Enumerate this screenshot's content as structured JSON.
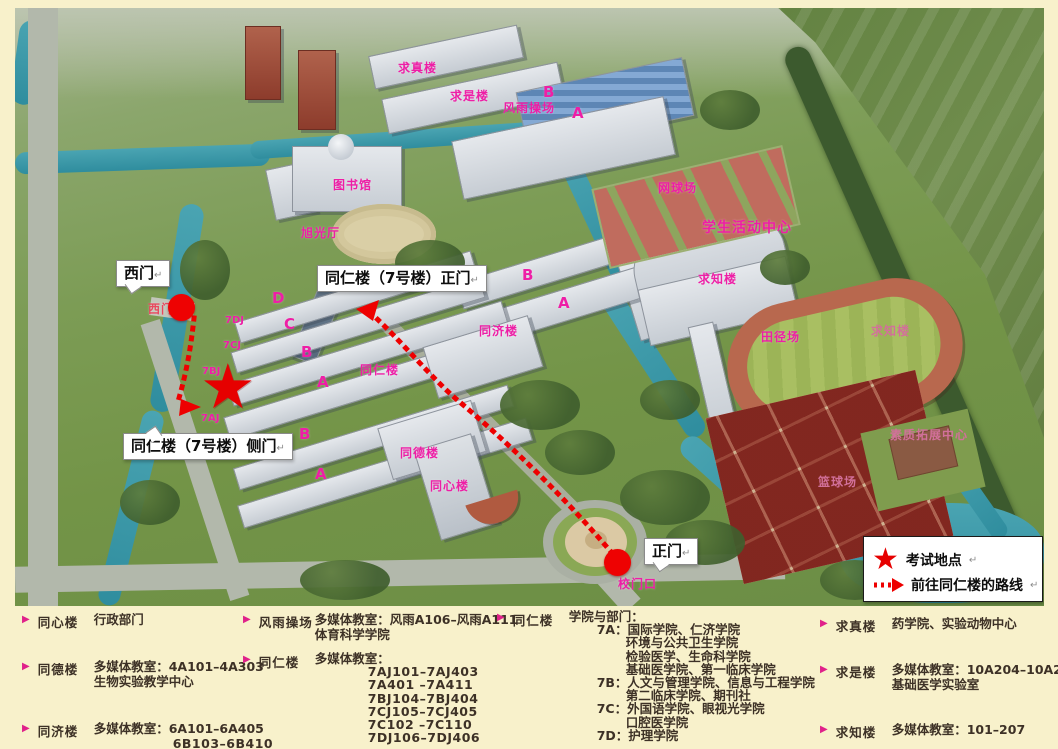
{
  "colors": {
    "accent_red": "#ee0000",
    "label_pink": "#ee1ea6",
    "panel_bg": "#f8f1cb"
  },
  "map": {
    "labels": {
      "qiuzhen": "求真楼",
      "qiushi": "求是楼",
      "fengyu": "风雨操场",
      "fengyu_b": "B",
      "fengyu_a": "A",
      "library": "图书馆",
      "xuguang": "旭光厅",
      "tennis": "网球场",
      "activity": "学生活动中心",
      "qiuzhi": "求知楼",
      "qiuzhi_east": "求知楼",
      "track": "田径场",
      "suzhi": "素质拓展中心",
      "basketball": "篮球场",
      "ximenkou": "西门口",
      "blk_d": "D",
      "blk_c": "C",
      "blk_b": "B",
      "blk_a": "A",
      "dj": "7DJ",
      "cj": "7CJ",
      "bj": "7BJ",
      "aj": "7AJ",
      "tongren": "同仁楼",
      "tongji_b": "B",
      "tongji_a": "A",
      "tongji": "同济楼",
      "blk_b2": "B",
      "blk_a2": "A",
      "tongde": "同德楼",
      "tongxin": "同心楼",
      "xiaomenkou": "校门口"
    },
    "callouts": {
      "west_gate": "西门",
      "front_door": "同仁楼（7号楼）正门",
      "side_door": "同仁楼（7号楼）侧门",
      "main_gate": "正门",
      "mark": "↵"
    },
    "legend": {
      "exam": "考试地点",
      "route": "前往同仁楼的路线",
      "mark": "↵"
    }
  },
  "panel": {
    "bullet": "▶",
    "groups": [
      {
        "name": "同心楼",
        "lines": [
          "行政部门"
        ]
      },
      {
        "name": "同德楼",
        "lines": [
          "多媒体教室：4A101–4A303",
          "生物实验教学中心"
        ]
      },
      {
        "name": "同济楼",
        "lines": [
          "多媒体教室：6A101–6A405",
          "6B103–6B410"
        ]
      },
      {
        "name": "风雨操场",
        "lines": [
          "多媒体教室：风雨A106–风雨A111",
          "体育科学学院"
        ]
      },
      {
        "name": "同仁楼",
        "lines": [
          "多媒体教室：",
          "7AJ101–7AJ403",
          "7A401 –7A411",
          "7BJ104–7BJ404",
          "7CJ105–7CJ405",
          "7C102 –7C110",
          "7DJ106–7DJ406"
        ]
      },
      {
        "name": "同仁楼",
        "lines": [
          "学院与部门：",
          "7A：国际学院、仁济学院",
          "环境与公共卫生学院",
          "检验医学、生命科学院",
          "基础医学院、第一临床学院",
          "7B：人文与管理学院、信息与工程学院",
          "第二临床学院、期刊社",
          "7C：外国语学院、眼视光学院",
          "口腔医学院",
          "7D：护理学院"
        ]
      },
      {
        "name": "求真楼",
        "lines": [
          "药学院、实验动物中心"
        ]
      },
      {
        "name": "求是楼",
        "lines": [
          "多媒体教室：10A204–10A213",
          "基础医学实验室"
        ]
      },
      {
        "name": "求知楼",
        "lines": [
          "多媒体教室：101–207"
        ]
      }
    ]
  }
}
